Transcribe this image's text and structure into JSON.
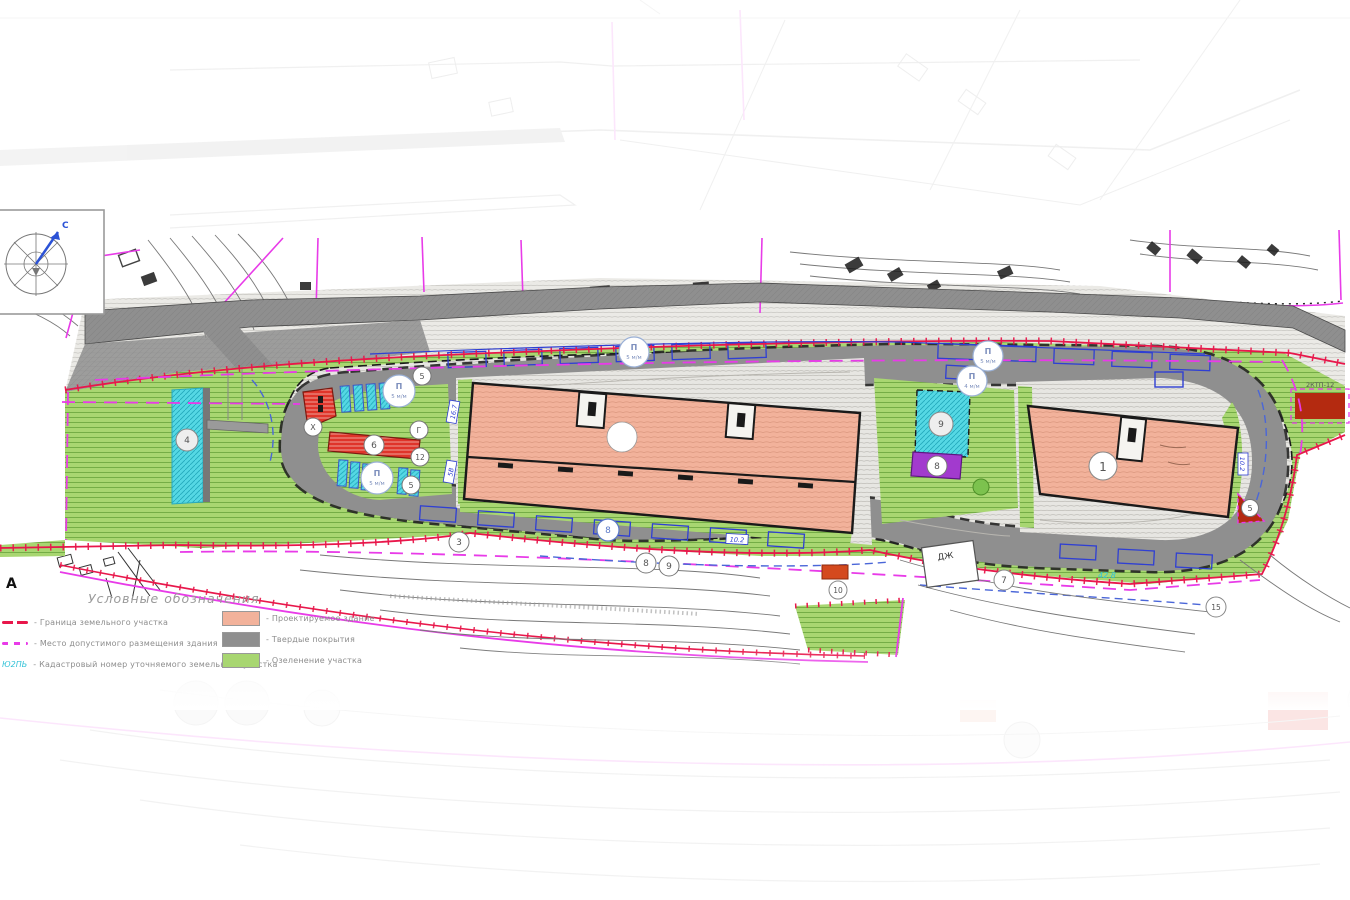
{
  "legend": {
    "title": "Условные обозначения",
    "left": [
      {
        "label": "- Граница земельного участка"
      },
      {
        "label": "- Место допустимого размещения здания"
      },
      {
        "label": "- Кадастровый номер уточняемого земельного участка",
        "symbol_text": "Ю2ПЬ"
      }
    ],
    "right": [
      {
        "label": "- Проектируемое здание"
      },
      {
        "label": "- Твердые покрытия"
      },
      {
        "label": "- Озеленение участка"
      }
    ]
  },
  "compass": {
    "north_label": "С"
  },
  "markers": [
    {
      "label": ""
    },
    {
      "label": "1"
    },
    {
      "label": "4"
    },
    {
      "label": "6"
    },
    {
      "label": "9"
    },
    {
      "label": "8"
    },
    {
      "label": "5"
    },
    {
      "label": "Х"
    },
    {
      "label": "Г"
    },
    {
      "label": "12"
    },
    {
      "label": "5"
    },
    {
      "label": "5"
    },
    {
      "label": "3"
    },
    {
      "label": "8"
    },
    {
      "label": "9"
    },
    {
      "label": "10"
    },
    {
      "label": "15"
    },
    {
      "label": "7"
    },
    {
      "label": "8"
    }
  ],
  "parking_badges": [
    {
      "letter": "П",
      "capacity": "5 м/м"
    },
    {
      "letter": "П",
      "capacity": "5 м/м"
    },
    {
      "letter": "П",
      "capacity": "5 м/м"
    },
    {
      "letter": "П",
      "capacity": "5 м/м"
    },
    {
      "letter": "П",
      "capacity": "4 м/м"
    }
  ],
  "map_labels": {
    "elev_a": "16.7",
    "elev_b": "5В",
    "elev_c": "10.2",
    "elev_d": "10.2",
    "dim": "42.8",
    "house": "ДЖ",
    "letter_a": "А",
    "substation": "2КТП-12"
  },
  "colors": {
    "green": "#a8d671",
    "green_line": "#5e9c33",
    "gray_road": "#8f8f8f",
    "pave": "#e7e6e2",
    "pave_line": "#b7b5af",
    "salmon": "#f2b29b",
    "salmon_line": "#d08b72",
    "cyan": "#55d8e4",
    "cyan_line": "#22a9bb",
    "purple": "#a23ace",
    "red": "#df342a",
    "dark_red": "#b42a10",
    "boundary_red": "#e8174b",
    "magenta": "#e83be8",
    "blue": "#2f3fd3",
    "blue_dash": "#4a66d8",
    "cyan_text": "#35c3d8",
    "ink": "#1a1a1a",
    "contour": "#787878",
    "legend_text": "#8a8a8a"
  }
}
